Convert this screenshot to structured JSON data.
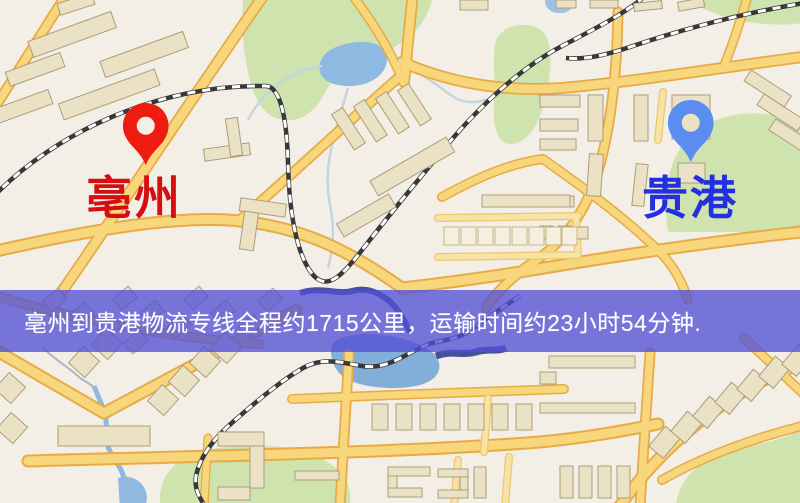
{
  "map": {
    "type": "logistics-route-map",
    "origin": {
      "city": "亳州",
      "marker_color": "#ee1c10",
      "label_color": "#d60e10"
    },
    "destination": {
      "city": "贵港",
      "marker_color": "#5b8cf0",
      "label_color": "#2430e0"
    },
    "banner": {
      "text": "亳州到贵港物流专线全程约1715公里，运输时间约23小时54分钟.",
      "distance": "约1715公里",
      "duration": "约23小时54分钟",
      "background_color": "rgba(82,79,213,0.78)",
      "text_color": "#ffffff"
    },
    "palette": {
      "background": "#f4efe6",
      "road_core": "#f7d67c",
      "road_casing": "#e7ab46",
      "building": "#ebe2c6",
      "green_area": "#cfe3af",
      "water": "#8fb9e0",
      "river_dark": "#45519f"
    }
  }
}
